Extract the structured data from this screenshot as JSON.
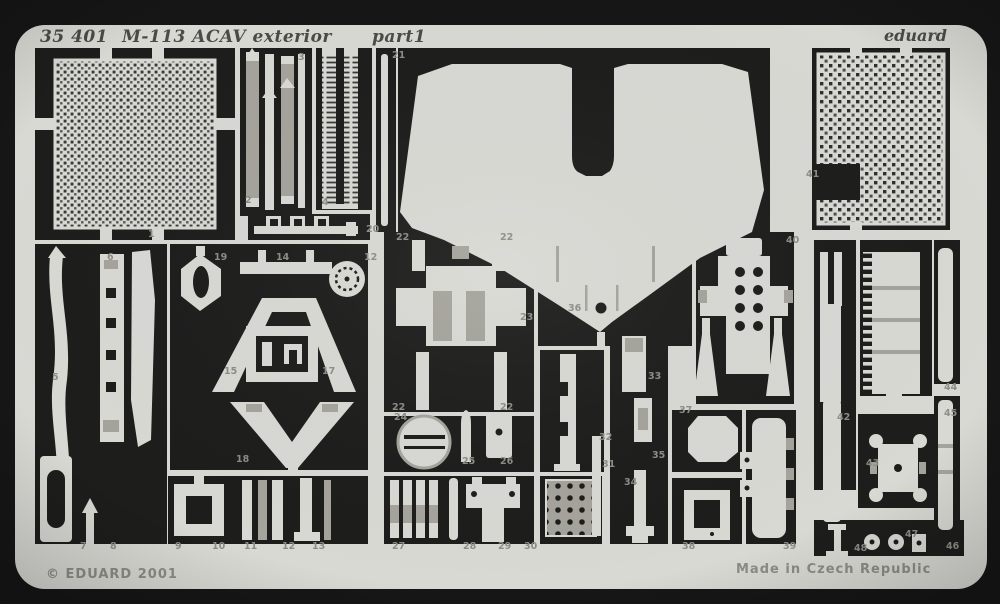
{
  "header": {
    "catalog_number": "35 401",
    "title": "M-113 ACAV exterior",
    "part_label": "part1",
    "brand": "eduard"
  },
  "footer": {
    "copyright": "© EDUARD 2001",
    "origin": "Made in Czech Republic"
  },
  "colors": {
    "background": "#161616",
    "fret": "#d9d9d4",
    "etched": "#1d1d1c",
    "half_etch": "#a5a49c",
    "number": "#8d8d86",
    "header_text": "#4a4a47"
  },
  "part_numbers": [
    {
      "label": "1",
      "x": 148,
      "y": 237
    },
    {
      "label": "2",
      "x": 245,
      "y": 203
    },
    {
      "label": "3",
      "x": 298,
      "y": 60
    },
    {
      "label": "4",
      "x": 322,
      "y": 205
    },
    {
      "label": "20",
      "x": 366,
      "y": 232
    },
    {
      "label": "21",
      "x": 392,
      "y": 58
    },
    {
      "label": "5",
      "x": 52,
      "y": 380
    },
    {
      "label": "6",
      "x": 107,
      "y": 260
    },
    {
      "label": "19",
      "x": 214,
      "y": 260
    },
    {
      "label": "14",
      "x": 276,
      "y": 260
    },
    {
      "label": "12",
      "x": 364,
      "y": 260
    },
    {
      "label": "15",
      "x": 224,
      "y": 374
    },
    {
      "label": "17",
      "x": 322,
      "y": 374
    },
    {
      "label": "18",
      "x": 236,
      "y": 462
    },
    {
      "label": "7",
      "x": 80,
      "y": 549
    },
    {
      "label": "8",
      "x": 110,
      "y": 549
    },
    {
      "label": "9",
      "x": 175,
      "y": 549
    },
    {
      "label": "10",
      "x": 212,
      "y": 549
    },
    {
      "label": "11",
      "x": 244,
      "y": 549
    },
    {
      "label": "12",
      "x": 282,
      "y": 549
    },
    {
      "label": "13",
      "x": 312,
      "y": 549
    },
    {
      "label": "22",
      "x": 396,
      "y": 240
    },
    {
      "label": "22",
      "x": 500,
      "y": 240
    },
    {
      "label": "23",
      "x": 520,
      "y": 320
    },
    {
      "label": "22",
      "x": 392,
      "y": 410
    },
    {
      "label": "22",
      "x": 500,
      "y": 410
    },
    {
      "label": "24",
      "x": 394,
      "y": 420
    },
    {
      "label": "25",
      "x": 462,
      "y": 464
    },
    {
      "label": "26",
      "x": 500,
      "y": 464
    },
    {
      "label": "27",
      "x": 392,
      "y": 549
    },
    {
      "label": "28",
      "x": 463,
      "y": 549
    },
    {
      "label": "29",
      "x": 498,
      "y": 549
    },
    {
      "label": "30",
      "x": 524,
      "y": 549
    },
    {
      "label": "36",
      "x": 568,
      "y": 311
    },
    {
      "label": "32",
      "x": 599,
      "y": 440
    },
    {
      "label": "31",
      "x": 602,
      "y": 467
    },
    {
      "label": "33",
      "x": 648,
      "y": 379
    },
    {
      "label": "35",
      "x": 652,
      "y": 458
    },
    {
      "label": "34",
      "x": 624,
      "y": 485
    },
    {
      "label": "37",
      "x": 679,
      "y": 413
    },
    {
      "label": "38",
      "x": 682,
      "y": 549
    },
    {
      "label": "39",
      "x": 783,
      "y": 549
    },
    {
      "label": "40",
      "x": 786,
      "y": 243
    },
    {
      "label": "41",
      "x": 806,
      "y": 177
    },
    {
      "label": "42",
      "x": 837,
      "y": 420
    },
    {
      "label": "43",
      "x": 866,
      "y": 466
    },
    {
      "label": "44",
      "x": 944,
      "y": 390
    },
    {
      "label": "45",
      "x": 944,
      "y": 416
    },
    {
      "label": "47",
      "x": 905,
      "y": 537
    },
    {
      "label": "48",
      "x": 854,
      "y": 551
    },
    {
      "label": "46",
      "x": 946,
      "y": 549
    }
  ]
}
